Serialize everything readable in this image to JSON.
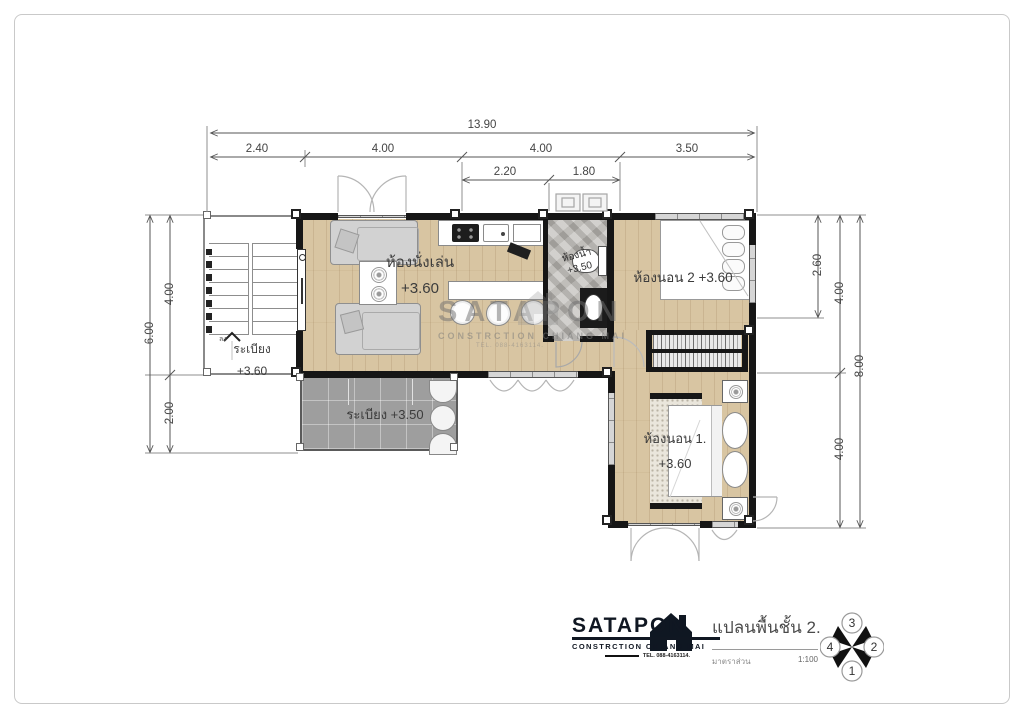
{
  "dimensions": {
    "top": {
      "total": "13.90",
      "segments": [
        "2.40",
        "4.00",
        "4.00",
        "3.50"
      ],
      "sub_segments": [
        "2.20",
        "1.80"
      ]
    },
    "left": {
      "total": "6.00",
      "segments": [
        "4.00",
        "2.00"
      ]
    },
    "right": {
      "inner": "2.60",
      "segments": [
        "4.00",
        "4.00"
      ],
      "total": "8.00"
    }
  },
  "rooms": {
    "living": {
      "name": "ห้องนั่งเล่น",
      "level": "+3.60"
    },
    "bathroom": {
      "name": "ห้องน้ำ",
      "level": "+3.50"
    },
    "bedroom2": {
      "name": "ห้องนอน 2",
      "level": "+3.60"
    },
    "bedroom1": {
      "name": "ห้องนอน 1.",
      "level": "+3.60"
    },
    "balcony_upper": {
      "name": "ระเบียง",
      "level": "+3.60"
    },
    "balcony_lower": {
      "name": "ระเบียง",
      "level": "+3.50"
    },
    "stair_direction": "ลง"
  },
  "brand": {
    "name": "SATAPON",
    "subtitle": "CONSTRCTION CHIANG MAI",
    "tel": "TEL. 088-4163114."
  },
  "titleblock": {
    "drawing_title": "แปลนพื้นชั้น 2.",
    "scale_label": "มาตราส่วน",
    "scale_value": "1:100"
  },
  "compass": {
    "top": "3",
    "right": "2",
    "bottom": "1",
    "left": "4"
  },
  "colors": {
    "wall": "#161616",
    "wood_floor": "#d8c5a2",
    "balcony_tile": "#9e9e9e",
    "bath_marble": "#b6b3ae"
  }
}
